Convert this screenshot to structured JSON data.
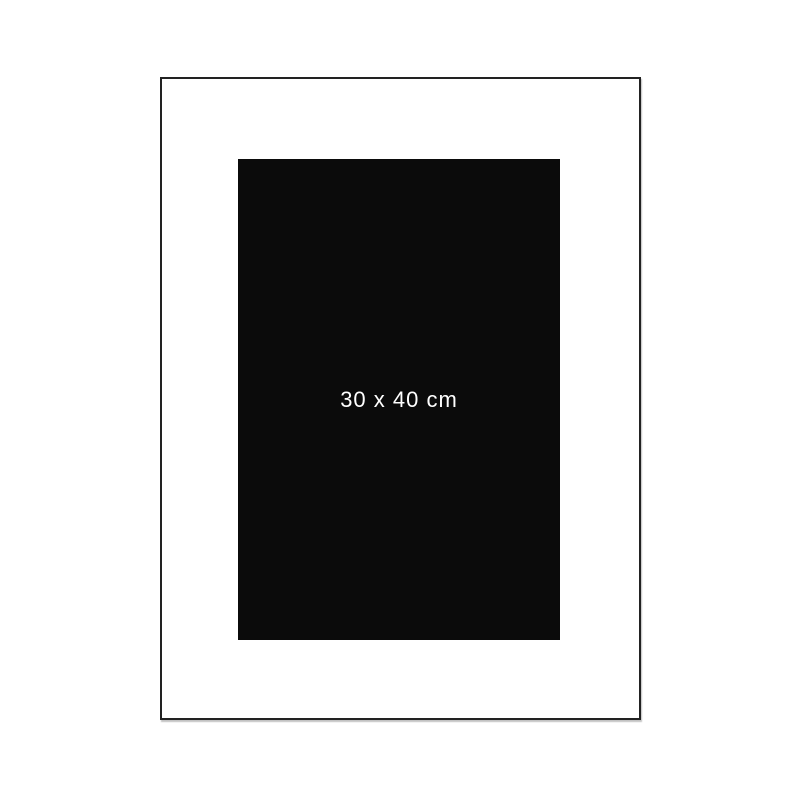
{
  "diagram": {
    "artwork": {
      "size_label": "30 x 40 cm"
    },
    "margins": {
      "left_label": "5 cm",
      "top_label": "5 cm"
    },
    "colors": {
      "dimension_line": "#d3a24d",
      "frame_border": "#222222",
      "artwork_fill": "#0b0b0b",
      "artwork_text": "#ffffff",
      "background": "#ffffff"
    }
  }
}
